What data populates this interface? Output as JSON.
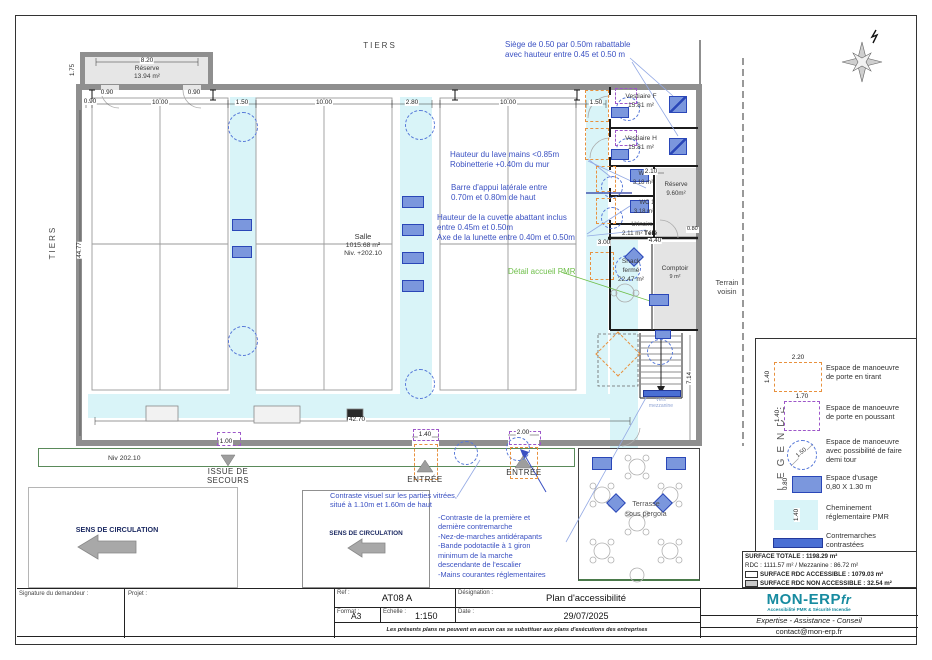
{
  "colors": {
    "accent_blue": "#3a50c2",
    "detail_green": "#6fbf4a",
    "cheminement_cyan": "#d9f4f8",
    "porte_tirant_orange": "#e8913e",
    "porte_poussant_purple": "#9d57c9",
    "usage_fill": "#7b97dd",
    "usage_border": "#2a47b8",
    "contremarche_blue": "#4a6fd4",
    "wall_gray": "#8f8f8f",
    "brand_teal": "#178ba0"
  },
  "plan": {
    "tiers_top": "TIERS",
    "tiers_left": "TIERS",
    "terrain_voisin_1": "Terrain",
    "terrain_voisin_2": "voisin",
    "rooms": {
      "reserve_tl": {
        "name": "Réserve",
        "area": "13.94 m²"
      },
      "salle": {
        "name": "Salle",
        "area": "1015.68 m²",
        "level": "Niv. +202.10"
      },
      "vestiaire_f": {
        "name": "Vestiaire F",
        "area": "15.81 m²"
      },
      "vestiaire_h": {
        "name": "Vestiaire H",
        "area": "15.81 m²"
      },
      "wc_a": {
        "name": "WC 1",
        "area": "3.18 m²"
      },
      "wc_b": {
        "name": "WC 1",
        "area": "3.18 m²"
      },
      "reserve_r": {
        "name": "Réserve",
        "area": "9.60m²"
      },
      "urinoirs": {
        "name": "Urinoirs",
        "area": "2.11 m²"
      },
      "tele": "Télé",
      "snack": {
        "name": "Snack",
        "status": "fermé",
        "area": "22.47 m²"
      },
      "comptoir": {
        "name": "Comptoir",
        "area": "9 m²"
      },
      "terrasse_1": "Terrasse",
      "terrasse_2": "sous pergola",
      "mezzanine_1": "vers",
      "mezzanine_2": "mezzanine"
    },
    "labels": {
      "issue_1": "ISSUE DE",
      "issue_2": "SECOURS",
      "entree_1": "ENTRÉE",
      "entree_2": "ENTRÉE",
      "niv": "Niv 202.10",
      "sens_1": "SENS DE CIRCULATION",
      "sens_2": "SENS DE CIRCULATION"
    },
    "dims": {
      "d820": "8.20",
      "d175": "1.75",
      "d090a": "0.90",
      "d090b": "0.90",
      "d090c": "0.90",
      "d1000a": "10.00",
      "d150a": "1.50",
      "d1000b": "10.00",
      "d280": "2.80",
      "d1000c": "10.00",
      "d150b": "1.50",
      "d210": "2.10",
      "d300": "3.00",
      "d440": "4.40",
      "d080": "0.80",
      "d4477": "44.77",
      "d4270": "42.70",
      "d714": "7.14",
      "d100": "1.00",
      "d140": "1.40",
      "d200": "2.00"
    }
  },
  "annotations": {
    "siege": [
      "Siège de 0.50 par 0.50m rabattable",
      "avec hauteur entre 0.45 et 0.50 m"
    ],
    "lave_mains": [
      "Hauteur du lave mains <0.85m",
      "Robinetterie +0.40m du mur"
    ],
    "barre": [
      "Barre d'appui latérale entre",
      "0.70m et 0.80m de haut"
    ],
    "cuvette": [
      "Hauteur de la cuvette abattant inclus",
      "entre 0.45m et 0.50m",
      "Axe de la lunette entre 0.40m et 0.50m"
    ],
    "detail_pmr": "Détail accueil PMR",
    "vitrage": [
      "Contraste visuel sur les parties vitrées,",
      "situé à 1.10m et 1.60m de haut"
    ],
    "escalier": [
      "-Contraste de la première et",
      "dernière contremarche",
      "-Nez-de-marches antidérapants",
      "-Bande podotactile à 1 giron",
      "minimum de la marche",
      "descendante de l'escalier",
      "-Mains courantes réglementaires"
    ]
  },
  "legend": {
    "title": "LEGENDE",
    "items": [
      {
        "l1": "Espace de manoeuvre",
        "l2": "de porte en tirant",
        "w": "2.20",
        "h": "1.40"
      },
      {
        "l1": "Espace de manoeuvre",
        "l2": "de porte en poussant",
        "w": "1.70",
        "h": "1.40"
      },
      {
        "l1": "Espace de manoeuvre",
        "l2": "avec possibilité de faire",
        "l3": "demi tour",
        "d": "1.50"
      },
      {
        "l1": "Espace d'usage",
        "l2": "0,80 X 1.30 m",
        "h": "0.80"
      },
      {
        "l1": "Cheminement",
        "l2": "réglementaire PMR",
        "h": "1.40"
      },
      {
        "l1": "Contremarches",
        "l2": "contrastées"
      }
    ]
  },
  "surface_table": {
    "rows": [
      {
        "text": "SURFACE TOTALE : 1198.29 m²"
      },
      {
        "text": "RDC : 1111.57 m² / Mezzanine : 86.72 m²"
      },
      {
        "text": "SURFACE RDC ACCESSIBLE : 1079.03 m²"
      },
      {
        "text": "SURFACE RDC NON ACCESSIBLE : 32.54 m²"
      }
    ]
  },
  "title_block": {
    "signature": "Signature du demandeur :",
    "projet": "Projet :",
    "ref_label": "Ref :",
    "ref": "AT08 A",
    "format_label": "Format :",
    "format": "A3",
    "echelle_label": "Echelle :",
    "echelle": "1:150",
    "designation_label": "Désignation :",
    "designation": "Plan d'accessibilité",
    "date_label": "Date :",
    "date": "29/07/2025",
    "disclaimer": "Les présents plans ne peuvent en aucun cas se substituer aux plans d'exécutions des entreprises"
  },
  "logo": {
    "brand": "MON-ERP",
    "suffix": "fr",
    "tagline": "Accessibilité PMR & Sécurité Incendie",
    "line": "Expertise - Assistance - Conseil",
    "email": "contact@mon-erp.fr"
  }
}
